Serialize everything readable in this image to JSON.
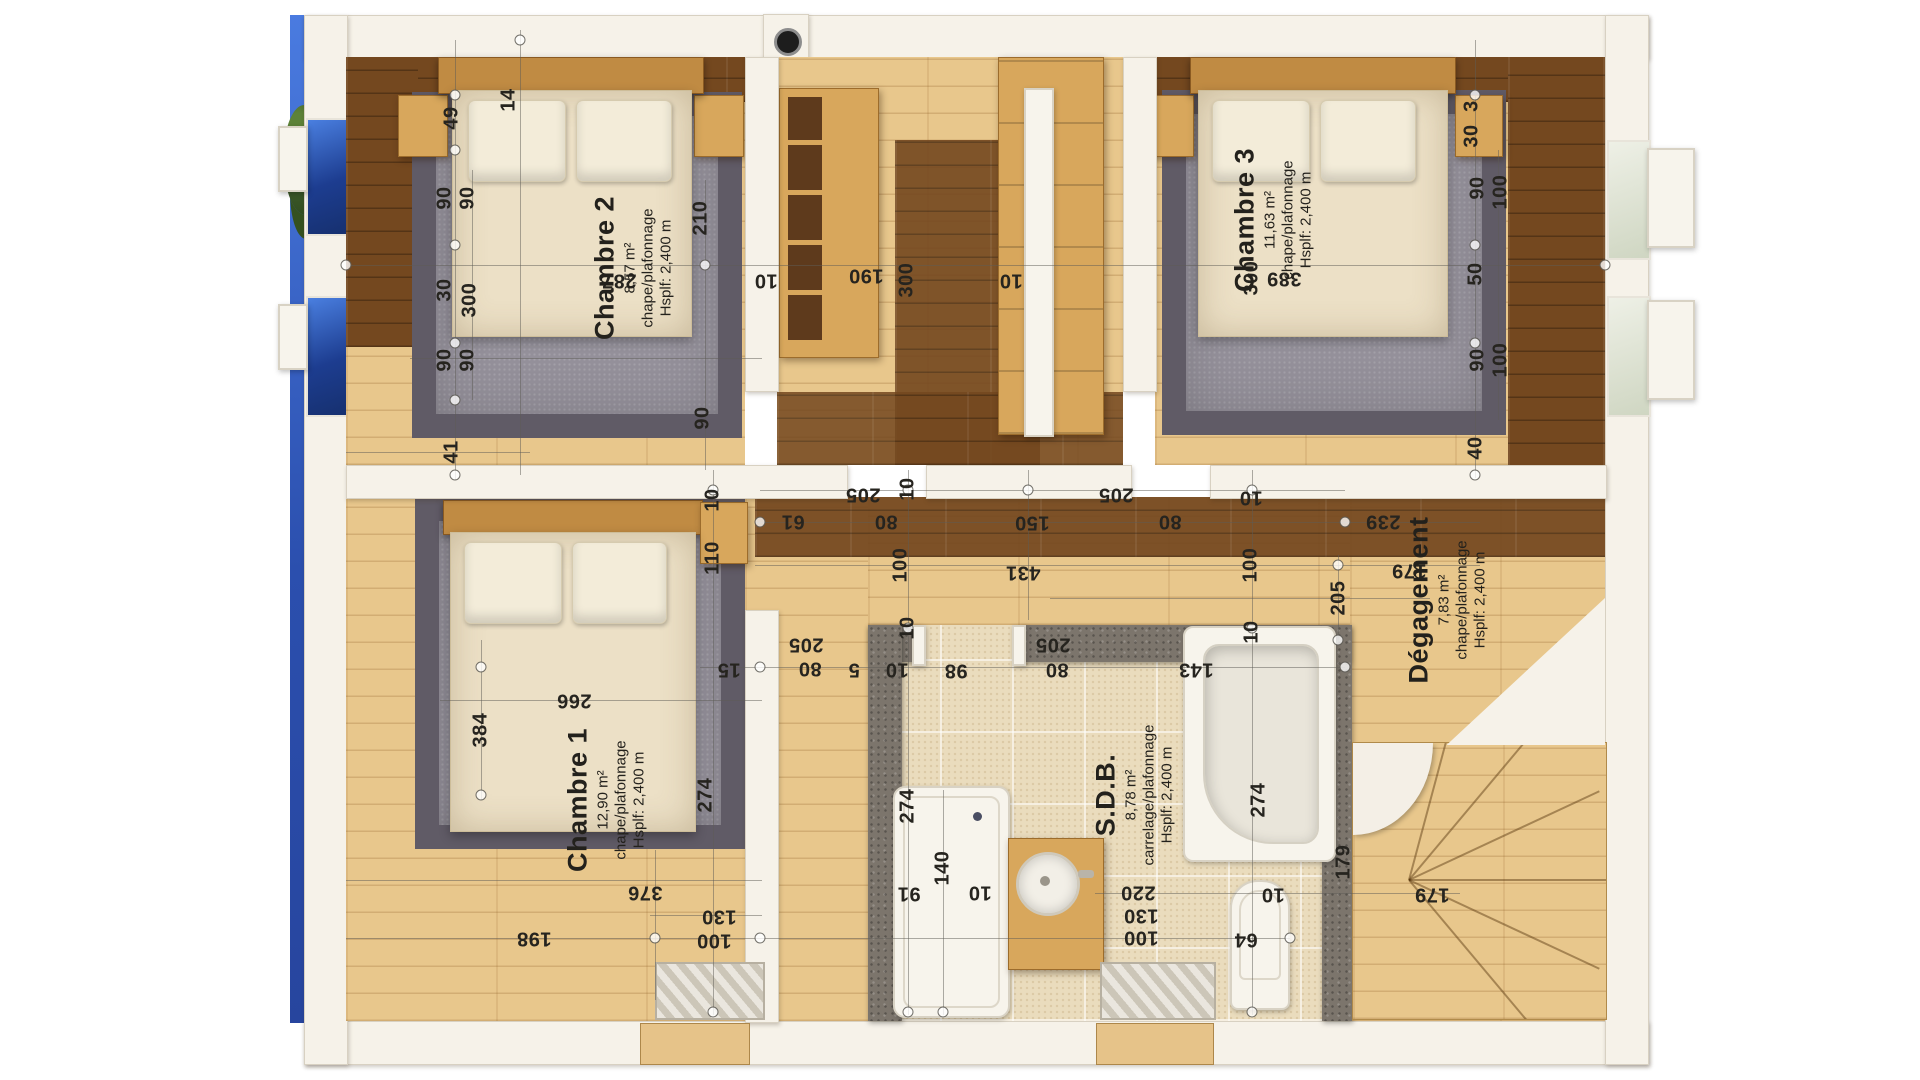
{
  "rooms": [
    {
      "name": "Chambre 2",
      "area": "8,57 m²",
      "finish": "chape/plafonnage",
      "height": "Hsplf: 2,400 m"
    },
    {
      "name": "Chambre 3",
      "area": "11,63 m²",
      "finish": "chape/plafonnage",
      "height": "Hsplf: 2,400 m"
    },
    {
      "name": "Chambre 1",
      "area": "12,90 m²",
      "finish": "chape/plafonnage",
      "height": "Hsplf: 2,400 m"
    },
    {
      "name": "S.D.B.",
      "area": "8,78 m²",
      "finish": "carrelage/plafonnage",
      "height": "Hsplf: 2,400 m"
    },
    {
      "name": "Dégagement",
      "area": "7,83 m²",
      "finish": "chape/plafonnage",
      "height": "Hsplf: 2,400 m"
    }
  ],
  "colors": {
    "pool_blue": "#3a63c8",
    "wood_light": "#e8c78c",
    "wood_dark": "#74481f",
    "carpet_gray": "#94909a",
    "tile_beige": "#eadcbd",
    "blockwork_gray": "#7c756c",
    "wall_white": "#f6f2e9",
    "dimension_text": "#26241f"
  },
  "annotations": {
    "labels": [
      {
        "v": "49",
        "x": 452,
        "y": 118,
        "r": "v"
      },
      {
        "v": "14",
        "x": 509,
        "y": 100,
        "r": "v"
      },
      {
        "v": "90",
        "x": 445,
        "y": 198,
        "r": "v"
      },
      {
        "v": "90",
        "x": 468,
        "y": 198,
        "r": "v"
      },
      {
        "v": "30",
        "x": 445,
        "y": 290,
        "r": "v"
      },
      {
        "v": "300",
        "x": 470,
        "y": 300,
        "r": "v"
      },
      {
        "v": "90",
        "x": 445,
        "y": 360,
        "r": "v"
      },
      {
        "v": "90",
        "x": 468,
        "y": 360,
        "r": "v"
      },
      {
        "v": "41",
        "x": 452,
        "y": 452,
        "r": "v"
      },
      {
        "v": "210",
        "x": 701,
        "y": 218,
        "r": "v"
      },
      {
        "v": "90",
        "x": 703,
        "y": 418,
        "r": "v"
      },
      {
        "v": "10",
        "x": 713,
        "y": 500,
        "r": "v"
      },
      {
        "v": "110",
        "x": 713,
        "y": 558,
        "r": "v"
      },
      {
        "v": "274",
        "x": 706,
        "y": 795,
        "r": "v"
      },
      {
        "v": "384",
        "x": 481,
        "y": 730,
        "r": "v"
      },
      {
        "v": "300",
        "x": 907,
        "y": 280,
        "r": "v"
      },
      {
        "v": "10",
        "x": 908,
        "y": 489,
        "r": "v"
      },
      {
        "v": "10",
        "x": 908,
        "y": 628,
        "r": "v"
      },
      {
        "v": "100",
        "x": 901,
        "y": 565,
        "r": "v"
      },
      {
        "v": "100",
        "x": 1251,
        "y": 565,
        "r": "v"
      },
      {
        "v": "205",
        "x": 1339,
        "y": 598,
        "r": "v"
      },
      {
        "v": "274",
        "x": 908,
        "y": 806,
        "r": "v"
      },
      {
        "v": "140",
        "x": 943,
        "y": 868,
        "r": "v"
      },
      {
        "v": "274",
        "x": 1259,
        "y": 800,
        "r": "v"
      },
      {
        "v": "179",
        "x": 1344,
        "y": 862,
        "r": "v"
      },
      {
        "v": "10",
        "x": 1252,
        "y": 632,
        "r": "v"
      },
      {
        "v": "300",
        "x": 1252,
        "y": 278,
        "r": "v"
      },
      {
        "v": "3",
        "x": 1472,
        "y": 106,
        "r": "v"
      },
      {
        "v": "30",
        "x": 1472,
        "y": 136,
        "r": "v"
      },
      {
        "v": "90",
        "x": 1478,
        "y": 188,
        "r": "v"
      },
      {
        "v": "100",
        "x": 1501,
        "y": 192,
        "r": "v"
      },
      {
        "v": "50",
        "x": 1476,
        "y": 274,
        "r": "v"
      },
      {
        "v": "90",
        "x": 1478,
        "y": 360,
        "r": "v"
      },
      {
        "v": "100",
        "x": 1501,
        "y": 360,
        "r": "v"
      },
      {
        "v": "40",
        "x": 1476,
        "y": 448,
        "r": "v"
      },
      {
        "v": "287",
        "x": 619,
        "y": 280,
        "r": "u"
      },
      {
        "v": "190",
        "x": 866,
        "y": 275,
        "r": "u"
      },
      {
        "v": "10",
        "x": 766,
        "y": 280,
        "r": "u"
      },
      {
        "v": "10",
        "x": 1011,
        "y": 280,
        "r": "u"
      },
      {
        "v": "389",
        "x": 1284,
        "y": 278,
        "r": "u"
      },
      {
        "v": "205",
        "x": 863,
        "y": 494,
        "r": "u"
      },
      {
        "v": "61",
        "x": 793,
        "y": 521,
        "r": "u"
      },
      {
        "v": "80",
        "x": 886,
        "y": 521,
        "r": "u"
      },
      {
        "v": "150",
        "x": 1032,
        "y": 522,
        "r": "u"
      },
      {
        "v": "205",
        "x": 1116,
        "y": 494,
        "r": "u"
      },
      {
        "v": "80",
        "x": 1170,
        "y": 521,
        "r": "u"
      },
      {
        "v": "10",
        "x": 1251,
        "y": 497,
        "r": "u"
      },
      {
        "v": "431",
        "x": 1023,
        "y": 572,
        "r": "u"
      },
      {
        "v": "239",
        "x": 1383,
        "y": 521,
        "r": "u"
      },
      {
        "v": "179",
        "x": 1409,
        "y": 570,
        "r": "u"
      },
      {
        "v": "15",
        "x": 729,
        "y": 669,
        "r": "u"
      },
      {
        "v": "266",
        "x": 574,
        "y": 700,
        "r": "u"
      },
      {
        "v": "376",
        "x": 645,
        "y": 892,
        "r": "u"
      },
      {
        "v": "198",
        "x": 534,
        "y": 938,
        "r": "u"
      },
      {
        "v": "130",
        "x": 719,
        "y": 916,
        "r": "u"
      },
      {
        "v": "100",
        "x": 714,
        "y": 940,
        "r": "u"
      },
      {
        "v": "205",
        "x": 806,
        "y": 644,
        "r": "u"
      },
      {
        "v": "80",
        "x": 810,
        "y": 668,
        "r": "u"
      },
      {
        "v": "5",
        "x": 854,
        "y": 669,
        "r": "u"
      },
      {
        "v": "10",
        "x": 897,
        "y": 669,
        "r": "u"
      },
      {
        "v": "98",
        "x": 956,
        "y": 670,
        "r": "u"
      },
      {
        "v": "205",
        "x": 1053,
        "y": 644,
        "r": "u"
      },
      {
        "v": "80",
        "x": 1057,
        "y": 669,
        "r": "u"
      },
      {
        "v": "143",
        "x": 1196,
        "y": 669,
        "r": "u"
      },
      {
        "v": "91",
        "x": 909,
        "y": 893,
        "r": "u"
      },
      {
        "v": "10",
        "x": 980,
        "y": 892,
        "r": "u"
      },
      {
        "v": "220",
        "x": 1138,
        "y": 892,
        "r": "u"
      },
      {
        "v": "130",
        "x": 1141,
        "y": 915,
        "r": "u"
      },
      {
        "v": "100",
        "x": 1141,
        "y": 937,
        "r": "u"
      },
      {
        "v": "64",
        "x": 1246,
        "y": 939,
        "r": "u"
      },
      {
        "v": "10",
        "x": 1273,
        "y": 894,
        "r": "u"
      },
      {
        "v": "179",
        "x": 1432,
        "y": 894,
        "r": "u"
      }
    ],
    "vlines": [
      [
        455,
        40,
        480
      ],
      [
        472,
        170,
        400
      ],
      [
        520,
        30,
        475
      ],
      [
        655,
        850,
        1000
      ],
      [
        705,
        180,
        470
      ],
      [
        713,
        470,
        1015
      ],
      [
        908,
        470,
        1015
      ],
      [
        943,
        790,
        1015
      ],
      [
        1028,
        470,
        620
      ],
      [
        1252,
        470,
        1015
      ],
      [
        1338,
        555,
        645
      ],
      [
        1475,
        40,
        478
      ],
      [
        1498,
        150,
        420
      ],
      [
        481,
        640,
        800
      ]
    ],
    "hlines": [
      [
        265,
        346,
        1605
      ],
      [
        358,
        410,
        762
      ],
      [
        452,
        346,
        530
      ],
      [
        490,
        760,
        1345
      ],
      [
        522,
        755,
        1480
      ],
      [
        565,
        755,
        1480
      ],
      [
        598,
        1050,
        1430
      ],
      [
        667,
        700,
        1345
      ],
      [
        700,
        440,
        762
      ],
      [
        880,
        346,
        762
      ],
      [
        915,
        650,
        762
      ],
      [
        938,
        346,
        1290
      ],
      [
        893,
        1095,
        1460
      ]
    ],
    "nodes": [
      [
        455,
        95
      ],
      [
        455,
        150
      ],
      [
        455,
        245
      ],
      [
        455,
        343
      ],
      [
        455,
        400
      ],
      [
        455,
        475
      ],
      [
        520,
        40
      ],
      [
        705,
        265
      ],
      [
        713,
        490
      ],
      [
        713,
        1012
      ],
      [
        908,
        490
      ],
      [
        908,
        628
      ],
      [
        908,
        1012
      ],
      [
        1028,
        490
      ],
      [
        1252,
        490
      ],
      [
        1252,
        628
      ],
      [
        1252,
        1012
      ],
      [
        1338,
        565
      ],
      [
        1338,
        640
      ],
      [
        1475,
        95
      ],
      [
        1475,
        245
      ],
      [
        1475,
        343
      ],
      [
        1475,
        475
      ],
      [
        346,
        265
      ],
      [
        1605,
        265
      ],
      [
        760,
        522
      ],
      [
        1345,
        522
      ],
      [
        760,
        667
      ],
      [
        1345,
        667
      ],
      [
        760,
        938
      ],
      [
        1290,
        938
      ],
      [
        943,
        1012
      ],
      [
        655,
        938
      ],
      [
        481,
        667
      ],
      [
        481,
        795
      ]
    ]
  }
}
